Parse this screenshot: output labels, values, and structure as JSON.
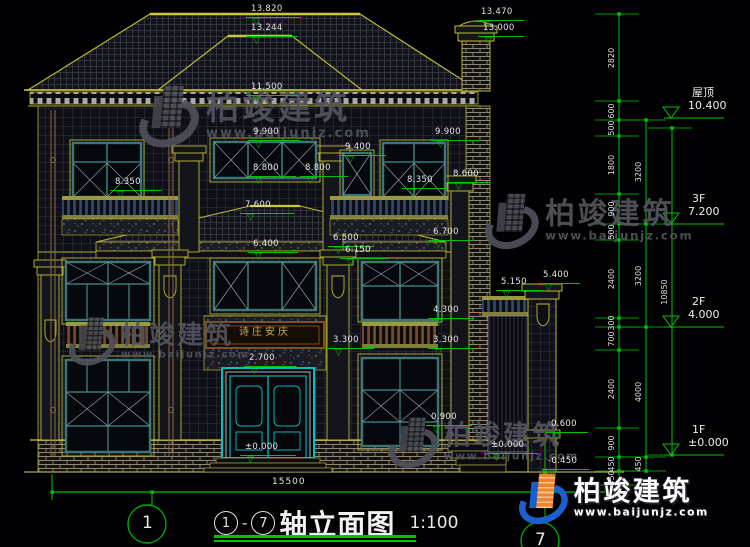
{
  "watermark": {
    "brand": "柏竣建筑",
    "url": "www.baijunjz.com"
  },
  "title": {
    "axis_from": "1",
    "separator": "-",
    "axis_to": "7",
    "name": "轴立面图",
    "scale": "1:100"
  },
  "ground": {
    "overall_width": "15500"
  },
  "axis_bubbles": {
    "left": "1",
    "right": "7"
  },
  "plaque": {
    "text": "诗庄安庆"
  },
  "levels": [
    {
      "name": "屋顶",
      "value": "10.400",
      "y": 118
    },
    {
      "name": "3F",
      "value": "7.200",
      "y": 224
    },
    {
      "name": "2F",
      "value": "4.000",
      "y": 327
    },
    {
      "name": "1F",
      "value": "±0.000",
      "y": 455
    }
  ],
  "dim_chains": [
    {
      "x": 619,
      "ticks": [
        14,
        101,
        120,
        136,
        194,
        224,
        240,
        318,
        327,
        350,
        428,
        457,
        471,
        485
      ],
      "labels": [
        "2820",
        "600",
        "500",
        "1800",
        "900",
        "500",
        "2400",
        "300",
        "700",
        "2400",
        "900",
        "450",
        "450"
      ]
    },
    {
      "x": 646,
      "ticks": [
        120,
        224,
        327,
        457,
        471
      ],
      "labels": [
        "3200",
        "3200",
        "4000",
        "450"
      ]
    },
    {
      "x": 672,
      "ticks": [
        128,
        455
      ],
      "labels": [
        "10850"
      ]
    }
  ],
  "marks": [
    {
      "t": "13.820",
      "x": 246,
      "y": 17,
      "w": 54
    },
    {
      "t": "13.244",
      "x": 246,
      "y": 36,
      "w": 52
    },
    {
      "t": "13.470",
      "x": 476,
      "y": 20,
      "w": 48
    },
    {
      "t": "13.000",
      "x": 478,
      "y": 36,
      "w": 46
    },
    {
      "t": "11.500",
      "x": 246,
      "y": 95,
      "w": 52
    },
    {
      "t": "9.900",
      "x": 248,
      "y": 140,
      "w": 52
    },
    {
      "t": "9.900",
      "x": 430,
      "y": 140,
      "w": 52
    },
    {
      "t": "9.400",
      "x": 340,
      "y": 155,
      "w": 46
    },
    {
      "t": "8.800",
      "x": 248,
      "y": 176,
      "w": 48
    },
    {
      "t": "8.800",
      "x": 300,
      "y": 176,
      "w": 48
    },
    {
      "t": "8.350",
      "x": 110,
      "y": 190,
      "w": 52
    },
    {
      "t": "8.350",
      "x": 402,
      "y": 188,
      "w": 46
    },
    {
      "t": "8.600",
      "x": 448,
      "y": 182,
      "w": 42
    },
    {
      "t": "7.600",
      "x": 240,
      "y": 213,
      "w": 54
    },
    {
      "t": "6.700",
      "x": 428,
      "y": 240,
      "w": 46
    },
    {
      "t": "6.400",
      "x": 248,
      "y": 252,
      "w": 50
    },
    {
      "t": "6.500",
      "x": 328,
      "y": 246,
      "w": 46
    },
    {
      "t": "6.150",
      "x": 340,
      "y": 258,
      "w": 48
    },
    {
      "t": "5.150",
      "x": 496,
      "y": 290,
      "w": 46
    },
    {
      "t": "5.400",
      "x": 538,
      "y": 283,
      "w": 42
    },
    {
      "t": "4.300",
      "x": 428,
      "y": 318,
      "w": 46
    },
    {
      "t": "3.300",
      "x": 328,
      "y": 348,
      "w": 46
    },
    {
      "t": "3.300",
      "x": 428,
      "y": 348,
      "w": 46
    },
    {
      "t": "2.700",
      "x": 244,
      "y": 366,
      "w": 52
    },
    {
      "t": "0.900",
      "x": 426,
      "y": 425,
      "w": 46
    },
    {
      "t": "0.600",
      "x": 546,
      "y": 432,
      "w": 42
    },
    {
      "t": "±0.000",
      "x": 240,
      "y": 455,
      "w": 56
    },
    {
      "t": "±0.000",
      "x": 486,
      "y": 453,
      "w": 52
    },
    {
      "t": "-0.450",
      "x": 543,
      "y": 469,
      "w": 46
    }
  ]
}
